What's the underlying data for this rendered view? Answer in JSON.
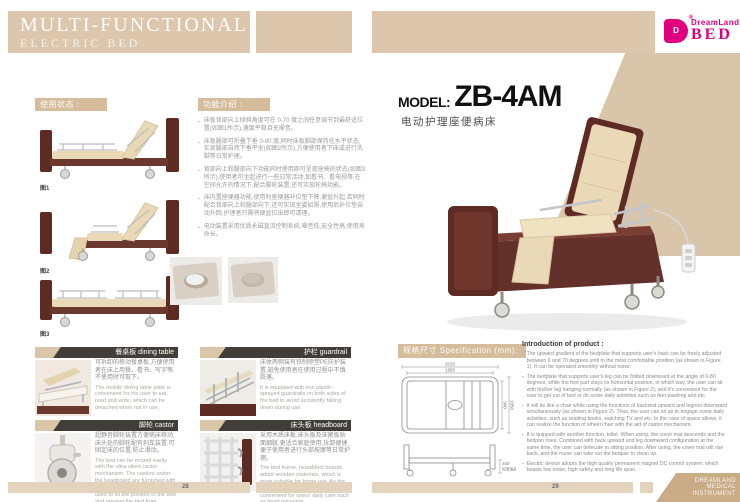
{
  "header": {
    "title_line1": "MULTI-FUNCTIONAL",
    "title_line2": "ELECTRIC BED",
    "logo": {
      "mark": "D",
      "reg": "®",
      "name": "DreamLand",
      "word": "BED"
    }
  },
  "left_page": {
    "usage_label": "使用状态 :",
    "figures": [
      {
        "caption": "图1"
      },
      {
        "caption": "图2"
      },
      {
        "caption": "图3"
      }
    ],
    "features_label": "功能介绍 :",
    "feature_bullets": [
      "床板背部向上倾斜角度可在 0-70 度之间任意调节到最舒适位置(如图1所示),速度平稳且无噪音。",
      "床板腿部可折叠下垂 0-80 度,同时床板脚部保持在水平状态,实现腿部自然下垂平坐(如图2所示),方便使用者下床或进行洗脚等日常护理。",
      "背部向上和腿部向下功能同时使用即可呈现座椅的状态(如图3所示),使用者可坐起进行一些日常活动,如看书、看电视等,在空间允许的情况下,配合脚轮装置,还可实现轮椅功能。",
      "床内置座便器功能,使用时座便器补位垫下降,便盆升起,若同时配合背部向上和腿部向下,还可实现坐姿如厕,使用后补位垫自动升回,护理者只需将便盆拉出即可清理。",
      "电动装置采用优质永磁直流控制系统,噪音低,安全性高,使用寿命长。"
    ],
    "feature_boxes": [
      {
        "title_zh": "餐桌板",
        "title_en": " dining table",
        "zh": "可拆卸的移动餐桌板,方便使用者在床上用餐、看书、写字等,不使用时可取下。",
        "en": "The mobile dining table plate is convenient for the user to eat, read and write, which can be detached when not in use."
      },
      {
        "title_zh": "护栏",
        "title_en": " guardrail",
        "zh": "床体两侧装有铁制喷塑PE防护装置,避免使用者在使用过程中不慎跌落。",
        "en": "It is equipped with iron plastic-sprayed guardrails on both sides of the bed to avoid accidently falling down during use."
      },
      {
        "title_zh": "脚轮",
        "title_en": " castor",
        "zh": "超静音脚轮装置方便病床移动,床头处的脚轮配有刹车装置,可固定床的位置,防止滑动。",
        "en": "The bed can be moved easily with the ultra-silent castor mechanism. The castors under the headboard are furnished with brake apparatus, which can be used to fix the position of the bed and prevent the bed from slipping."
      },
      {
        "title_zh": "床头板",
        "title_en": " headboard",
        "zh": "采用木质床板,床头板及床尾板贴面细腻,更适合家庭使用,拆卸便捷,便于使用者进行头部按摩等日常护理。",
        "en": "The bed frame, head&foot boards adopt wooden materials, which is more suitable for home use. As the boards are detachable, it's convenient for users' daily care such as head massage."
      }
    ],
    "page_number": "28"
  },
  "right_page": {
    "model_label": "MODEL:",
    "model_value": "ZB-4AM",
    "model_sub": "电动护理座便病床",
    "spec_label": "规格尺寸 Specification (mm):",
    "spec_dims": {
      "outer_length": "2020",
      "inner_length": "1950",
      "inner_width": "900",
      "outer_width": "1050",
      "height": "450",
      "height_note": "标准高度"
    },
    "intro_title": "Introduction of product :",
    "intro_bullets": [
      "The upward gradient of the bedplate that supports user's back can be freely adjusted between 0 and 70 degrees until to the most comfortable position (as shown in Figure 1). It can be operated smoothly without noise.",
      "The bedplate that supports user's leg can be folded downward at the angle of 0-80 degrees, while the foot part stays its horizontal position, in which way, the user can sit with his/her leg hanging normally (as shown in Figure 2), and it's convenient for the user to get out of bed or do some daily activities such as feet washing and etc.",
      "It will be like a chair while using the functions of backrest upward and legrest downward simultaneously (as shown in Figure 2). Thus, the user can sit up to engage some daily activities, such as reading books, watching TV and etc. In the case of space allows, it can realize the function of wheel chair with the aid of castor mechanism.",
      "It is quipped with another function, toilet. When using, the cover mat descends and the bedpan rises. Combined with back upward and leg downward configuration at the same time, the user can defecate in sitting position. After using, the cover mat will rise back, and the nurse can take out the bedpan to clean up.",
      "Electric device adopts the high quality permanent magnet DC control system, which boasts low noise, high safety and long life span."
    ],
    "page_number": "29",
    "footer_badge": {
      "line1": "DREAMLAND",
      "line2": "MEDICAL",
      "line3": "INSTRUMENT"
    }
  },
  "colors": {
    "banner_tan": "#dcc7ac",
    "label_tan": "#d5bd9c",
    "footer_tan": "#e3d3bc",
    "badge_tan": "#c9ab85",
    "header_bar_dark": "#413d38",
    "brand_magenta": "#e0007f",
    "wood_brown": "#5e2b23",
    "cushion_cream": "#ead9b6"
  }
}
